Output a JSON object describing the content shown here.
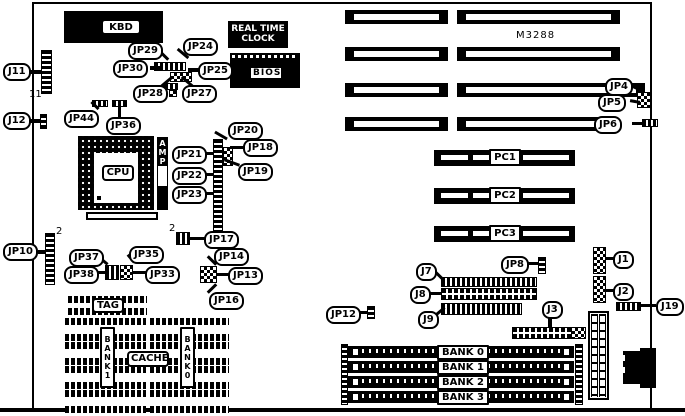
{
  "diagram": "motherboard-layout",
  "chips": {
    "kbd": "KBD",
    "rtc_line1": "REAL TIME",
    "rtc_line2": "CLOCK",
    "bios": "BIOS",
    "cpu": "CPU",
    "amp": "AMP",
    "model": "M3288",
    "tag": "TAG",
    "cache": "CACHE",
    "bank1_col": "BANK1",
    "bank0_col": "BANK0"
  },
  "callouts": {
    "j11": "J11",
    "j12": "J12",
    "jp44": "JP44",
    "jp36": "JP36",
    "jp29": "JP29",
    "jp24": "JP24",
    "jp30": "JP30",
    "jp25": "JP25",
    "jp28": "JP28",
    "jp27": "JP27",
    "jp20": "JP20",
    "jp21": "JP21",
    "jp18": "JP18",
    "jp22": "JP22",
    "jp19": "JP19",
    "jp23": "JP23",
    "jp4": "JP4",
    "jp5": "JP5",
    "jp6": "JP6",
    "jp10": "JP10",
    "jp37": "JP37",
    "jp35": "JP35",
    "jp38": "JP38",
    "jp33": "JP33",
    "jp17": "JP17",
    "jp14": "JP14",
    "jp13": "JP13",
    "jp16": "JP16",
    "jp12": "JP12",
    "j7": "J7",
    "j8": "J8",
    "j9": "J9",
    "jp8": "JP8",
    "j3": "J3",
    "j1": "J1",
    "j2": "J2",
    "j19": "J19"
  },
  "pins": {
    "j11": "11",
    "jp10": "2",
    "jp17": "2"
  },
  "slots": {
    "pci": [
      "PC1",
      "PC2",
      "PC3"
    ],
    "simm": [
      "BANK 0",
      "BANK 1",
      "BANK 2",
      "BANK 3"
    ]
  },
  "colors": {
    "ink": "#000000",
    "board": "#ffffff"
  }
}
